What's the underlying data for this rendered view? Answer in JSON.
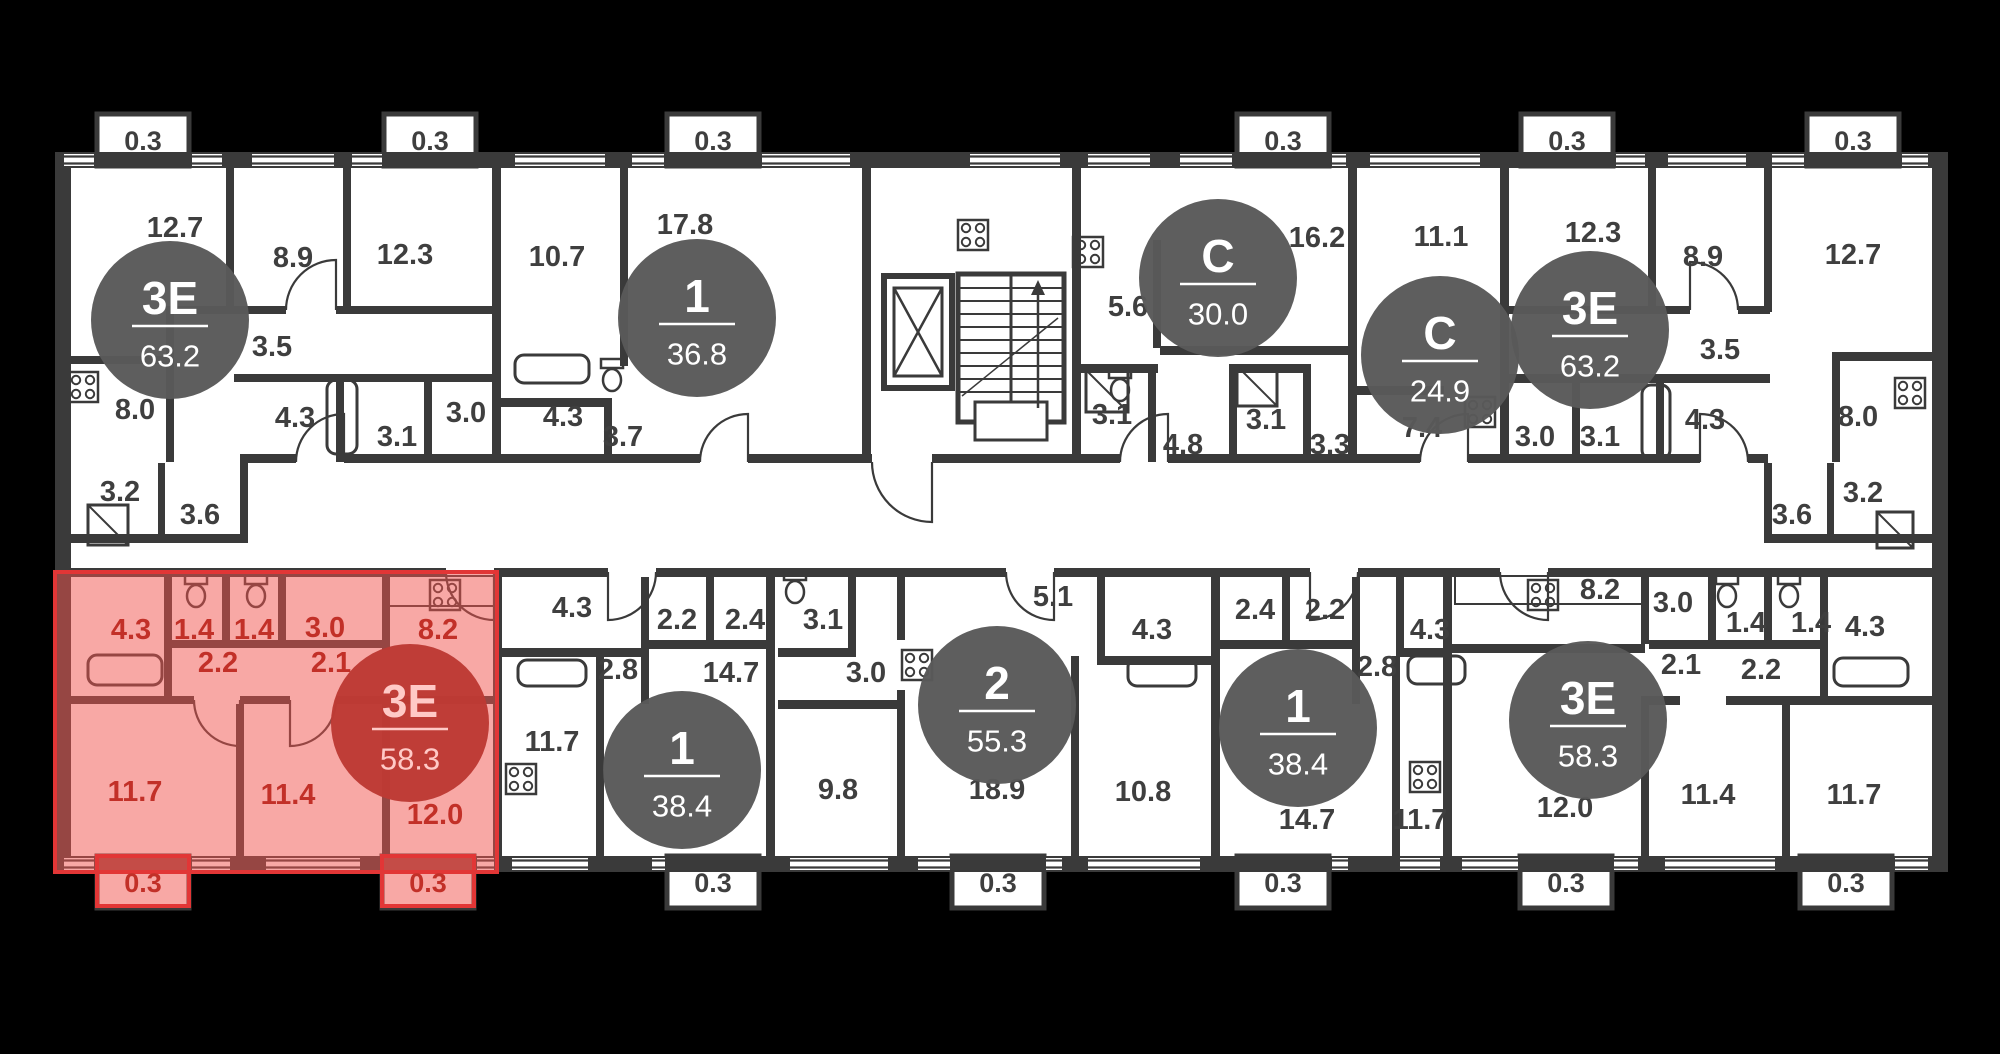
{
  "plan": {
    "colors": {
      "background": "#000000",
      "floor": "#ffffff",
      "wall": "#3a3a3a",
      "label": "#3f3f3f",
      "badge_fill": "#595959",
      "badge_text": "#ffffff",
      "highlight_fill": "#f2524b",
      "highlight_outline": "#e23636",
      "highlight_label": "#c23028",
      "highlight_badge_fill": "#bd3a34",
      "highlight_badge_text": "#ffc9c6"
    },
    "apartments": [
      {
        "id": "apt-3e-63-left",
        "type": "3Е",
        "area": "63.2",
        "highlighted": false,
        "badge": {
          "x": 170,
          "y": 320
        },
        "rooms": [
          {
            "area": "12.7",
            "x": 175,
            "y": 228
          },
          {
            "area": "8.9",
            "x": 293,
            "y": 258
          },
          {
            "area": "12.3",
            "x": 405,
            "y": 255
          },
          {
            "area": "3.5",
            "x": 272,
            "y": 347
          },
          {
            "area": "8.0",
            "x": 135,
            "y": 410
          },
          {
            "area": "4.3",
            "x": 295,
            "y": 418
          },
          {
            "area": "3.1",
            "x": 397,
            "y": 437
          },
          {
            "area": "3.0",
            "x": 466,
            "y": 413
          },
          {
            "area": "3.2",
            "x": 120,
            "y": 492
          },
          {
            "area": "3.6",
            "x": 200,
            "y": 515
          }
        ]
      },
      {
        "id": "apt-1-36",
        "type": "1",
        "area": "36.8",
        "highlighted": false,
        "badge": {
          "x": 697,
          "y": 318
        },
        "rooms": [
          {
            "area": "10.7",
            "x": 557,
            "y": 257
          },
          {
            "area": "17.8",
            "x": 685,
            "y": 225
          },
          {
            "area": "4.3",
            "x": 563,
            "y": 417
          },
          {
            "area": "3.7",
            "x": 623,
            "y": 437
          }
        ]
      },
      {
        "id": "apt-s-30",
        "type": "С",
        "area": "30.0",
        "highlighted": false,
        "badge": {
          "x": 1218,
          "y": 278
        },
        "rooms": [
          {
            "area": "5.6",
            "x": 1128,
            "y": 307
          },
          {
            "area": "16.2",
            "x": 1317,
            "y": 238
          },
          {
            "area": "3.1",
            "x": 1112,
            "y": 415
          },
          {
            "area": "4.8",
            "x": 1183,
            "y": 445
          }
        ]
      },
      {
        "id": "apt-s-24",
        "type": "С",
        "area": "24.9",
        "highlighted": false,
        "badge": {
          "x": 1440,
          "y": 355
        },
        "rooms": [
          {
            "area": "11.1",
            "x": 1441,
            "y": 237
          },
          {
            "area": "3.1",
            "x": 1266,
            "y": 420
          },
          {
            "area": "3.3",
            "x": 1330,
            "y": 445
          },
          {
            "area": "7.4",
            "x": 1422,
            "y": 428
          }
        ]
      },
      {
        "id": "apt-3e-63-right",
        "type": "3Е",
        "area": "63.2",
        "highlighted": false,
        "badge": {
          "x": 1590,
          "y": 330
        },
        "rooms": [
          {
            "area": "12.3",
            "x": 1593,
            "y": 233
          },
          {
            "area": "8.9",
            "x": 1703,
            "y": 257
          },
          {
            "area": "12.7",
            "x": 1853,
            "y": 255
          },
          {
            "area": "3.5",
            "x": 1720,
            "y": 350
          },
          {
            "area": "3.0",
            "x": 1535,
            "y": 437
          },
          {
            "area": "3.1",
            "x": 1600,
            "y": 437
          },
          {
            "area": "4.3",
            "x": 1705,
            "y": 420
          },
          {
            "area": "8.0",
            "x": 1858,
            "y": 417
          },
          {
            "area": "3.2",
            "x": 1863,
            "y": 493
          },
          {
            "area": "3.6",
            "x": 1792,
            "y": 515
          }
        ]
      },
      {
        "id": "apt-3e-58-highlighted",
        "type": "3Е",
        "area": "58.3",
        "highlighted": true,
        "badge": {
          "x": 410,
          "y": 723
        },
        "rooms": [
          {
            "area": "4.3",
            "x": 131,
            "y": 630
          },
          {
            "area": "1.4",
            "x": 194,
            "y": 630
          },
          {
            "area": "1.4",
            "x": 254,
            "y": 630
          },
          {
            "area": "3.0",
            "x": 325,
            "y": 628
          },
          {
            "area": "8.2",
            "x": 438,
            "y": 630
          },
          {
            "area": "2.2",
            "x": 218,
            "y": 663
          },
          {
            "area": "2.1",
            "x": 331,
            "y": 663
          },
          {
            "area": "11.7",
            "x": 135,
            "y": 792
          },
          {
            "area": "11.4",
            "x": 288,
            "y": 795
          },
          {
            "area": "12.0",
            "x": 435,
            "y": 815
          }
        ]
      },
      {
        "id": "apt-1-38-left",
        "type": "1",
        "area": "38.4",
        "highlighted": false,
        "badge": {
          "x": 682,
          "y": 770
        },
        "rooms": [
          {
            "area": "4.3",
            "x": 572,
            "y": 608
          },
          {
            "area": "2.2",
            "x": 677,
            "y": 620
          },
          {
            "area": "2.4",
            "x": 745,
            "y": 620
          },
          {
            "area": "2.8",
            "x": 618,
            "y": 670
          },
          {
            "area": "14.7",
            "x": 731,
            "y": 673
          },
          {
            "area": "11.7",
            "x": 552,
            "y": 742
          }
        ]
      },
      {
        "id": "apt-2-55",
        "type": "2",
        "area": "55.3",
        "highlighted": false,
        "badge": {
          "x": 997,
          "y": 705
        },
        "rooms": [
          {
            "area": "3.1",
            "x": 823,
            "y": 620
          },
          {
            "area": "3.0",
            "x": 866,
            "y": 673
          },
          {
            "area": "5.1",
            "x": 1053,
            "y": 597
          },
          {
            "area": "4.3",
            "x": 1152,
            "y": 630
          },
          {
            "area": "9.8",
            "x": 838,
            "y": 790
          },
          {
            "area": "18.9",
            "x": 997,
            "y": 790
          },
          {
            "area": "10.8",
            "x": 1143,
            "y": 792
          }
        ]
      },
      {
        "id": "apt-1-38-right",
        "type": "1",
        "area": "38.4",
        "highlighted": false,
        "badge": {
          "x": 1298,
          "y": 728
        },
        "rooms": [
          {
            "area": "2.4",
            "x": 1255,
            "y": 610
          },
          {
            "area": "2.2",
            "x": 1325,
            "y": 610
          },
          {
            "area": "2.8",
            "x": 1377,
            "y": 667
          },
          {
            "area": "4.3",
            "x": 1430,
            "y": 630
          },
          {
            "area": "14.7",
            "x": 1307,
            "y": 820
          },
          {
            "area": "11.7",
            "x": 1420,
            "y": 820
          }
        ]
      },
      {
        "id": "apt-3e-58-right",
        "type": "3Е",
        "area": "58.3",
        "highlighted": false,
        "badge": {
          "x": 1588,
          "y": 720
        },
        "rooms": [
          {
            "area": "8.2",
            "x": 1600,
            "y": 590
          },
          {
            "area": "3.0",
            "x": 1673,
            "y": 603
          },
          {
            "area": "2.1",
            "x": 1681,
            "y": 665
          },
          {
            "area": "1.4",
            "x": 1746,
            "y": 623
          },
          {
            "area": "1.4",
            "x": 1811,
            "y": 623
          },
          {
            "area": "2.2",
            "x": 1761,
            "y": 670
          },
          {
            "area": "4.3",
            "x": 1865,
            "y": 627
          },
          {
            "area": "12.0",
            "x": 1565,
            "y": 808
          },
          {
            "area": "11.4",
            "x": 1708,
            "y": 795
          },
          {
            "area": "11.7",
            "x": 1854,
            "y": 795
          }
        ]
      }
    ],
    "balconies": [
      {
        "area": "0.3",
        "x": 143,
        "y": 141,
        "edge": "top",
        "highlighted": false
      },
      {
        "area": "0.3",
        "x": 430,
        "y": 141,
        "edge": "top",
        "highlighted": false
      },
      {
        "area": "0.3",
        "x": 713,
        "y": 141,
        "edge": "top",
        "highlighted": false
      },
      {
        "area": "0.3",
        "x": 1283,
        "y": 141,
        "edge": "top",
        "highlighted": false
      },
      {
        "area": "0.3",
        "x": 1567,
        "y": 141,
        "edge": "top",
        "highlighted": false
      },
      {
        "area": "0.3",
        "x": 1853,
        "y": 141,
        "edge": "top",
        "highlighted": false
      },
      {
        "area": "0.3",
        "x": 143,
        "y": 883,
        "edge": "bottom",
        "highlighted": true
      },
      {
        "area": "0.3",
        "x": 428,
        "y": 883,
        "edge": "bottom",
        "highlighted": true
      },
      {
        "area": "0.3",
        "x": 713,
        "y": 883,
        "edge": "bottom",
        "highlighted": false
      },
      {
        "area": "0.3",
        "x": 998,
        "y": 883,
        "edge": "bottom",
        "highlighted": false
      },
      {
        "area": "0.3",
        "x": 1283,
        "y": 883,
        "edge": "bottom",
        "highlighted": false
      },
      {
        "area": "0.3",
        "x": 1566,
        "y": 883,
        "edge": "bottom",
        "highlighted": false
      },
      {
        "area": "0.3",
        "x": 1846,
        "y": 883,
        "edge": "bottom",
        "highlighted": false
      }
    ]
  }
}
